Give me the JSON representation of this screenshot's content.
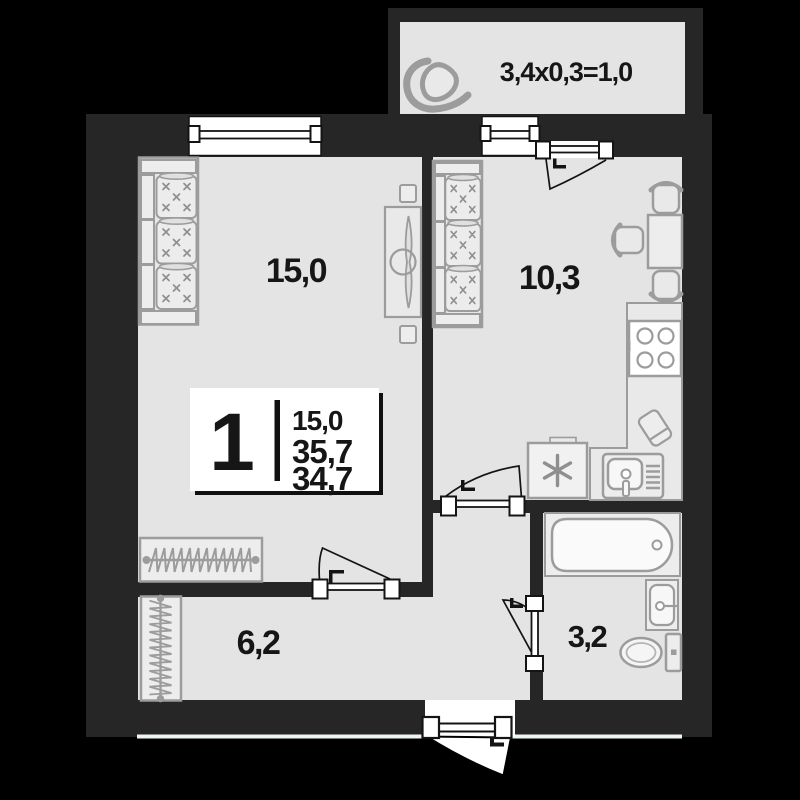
{
  "balcony": {
    "label": "3,4х0,3=1,0"
  },
  "rooms": {
    "living_room": {
      "area_label": "15,0"
    },
    "kitchen": {
      "area_label": "10,3"
    },
    "hallway": {
      "area_label": "6,2"
    },
    "bathroom": {
      "area_label": "3,2"
    }
  },
  "legend": {
    "room_count": "1",
    "living_area": "15,0",
    "total_area": "35,7",
    "reduced_area": "34,7"
  },
  "colors": {
    "background": "#000000",
    "wall": "#262626",
    "floor": "#e4e4e4",
    "furniture_outline": "#9c9c9c",
    "fixture_white": "#ffffff",
    "text": "#161616"
  }
}
